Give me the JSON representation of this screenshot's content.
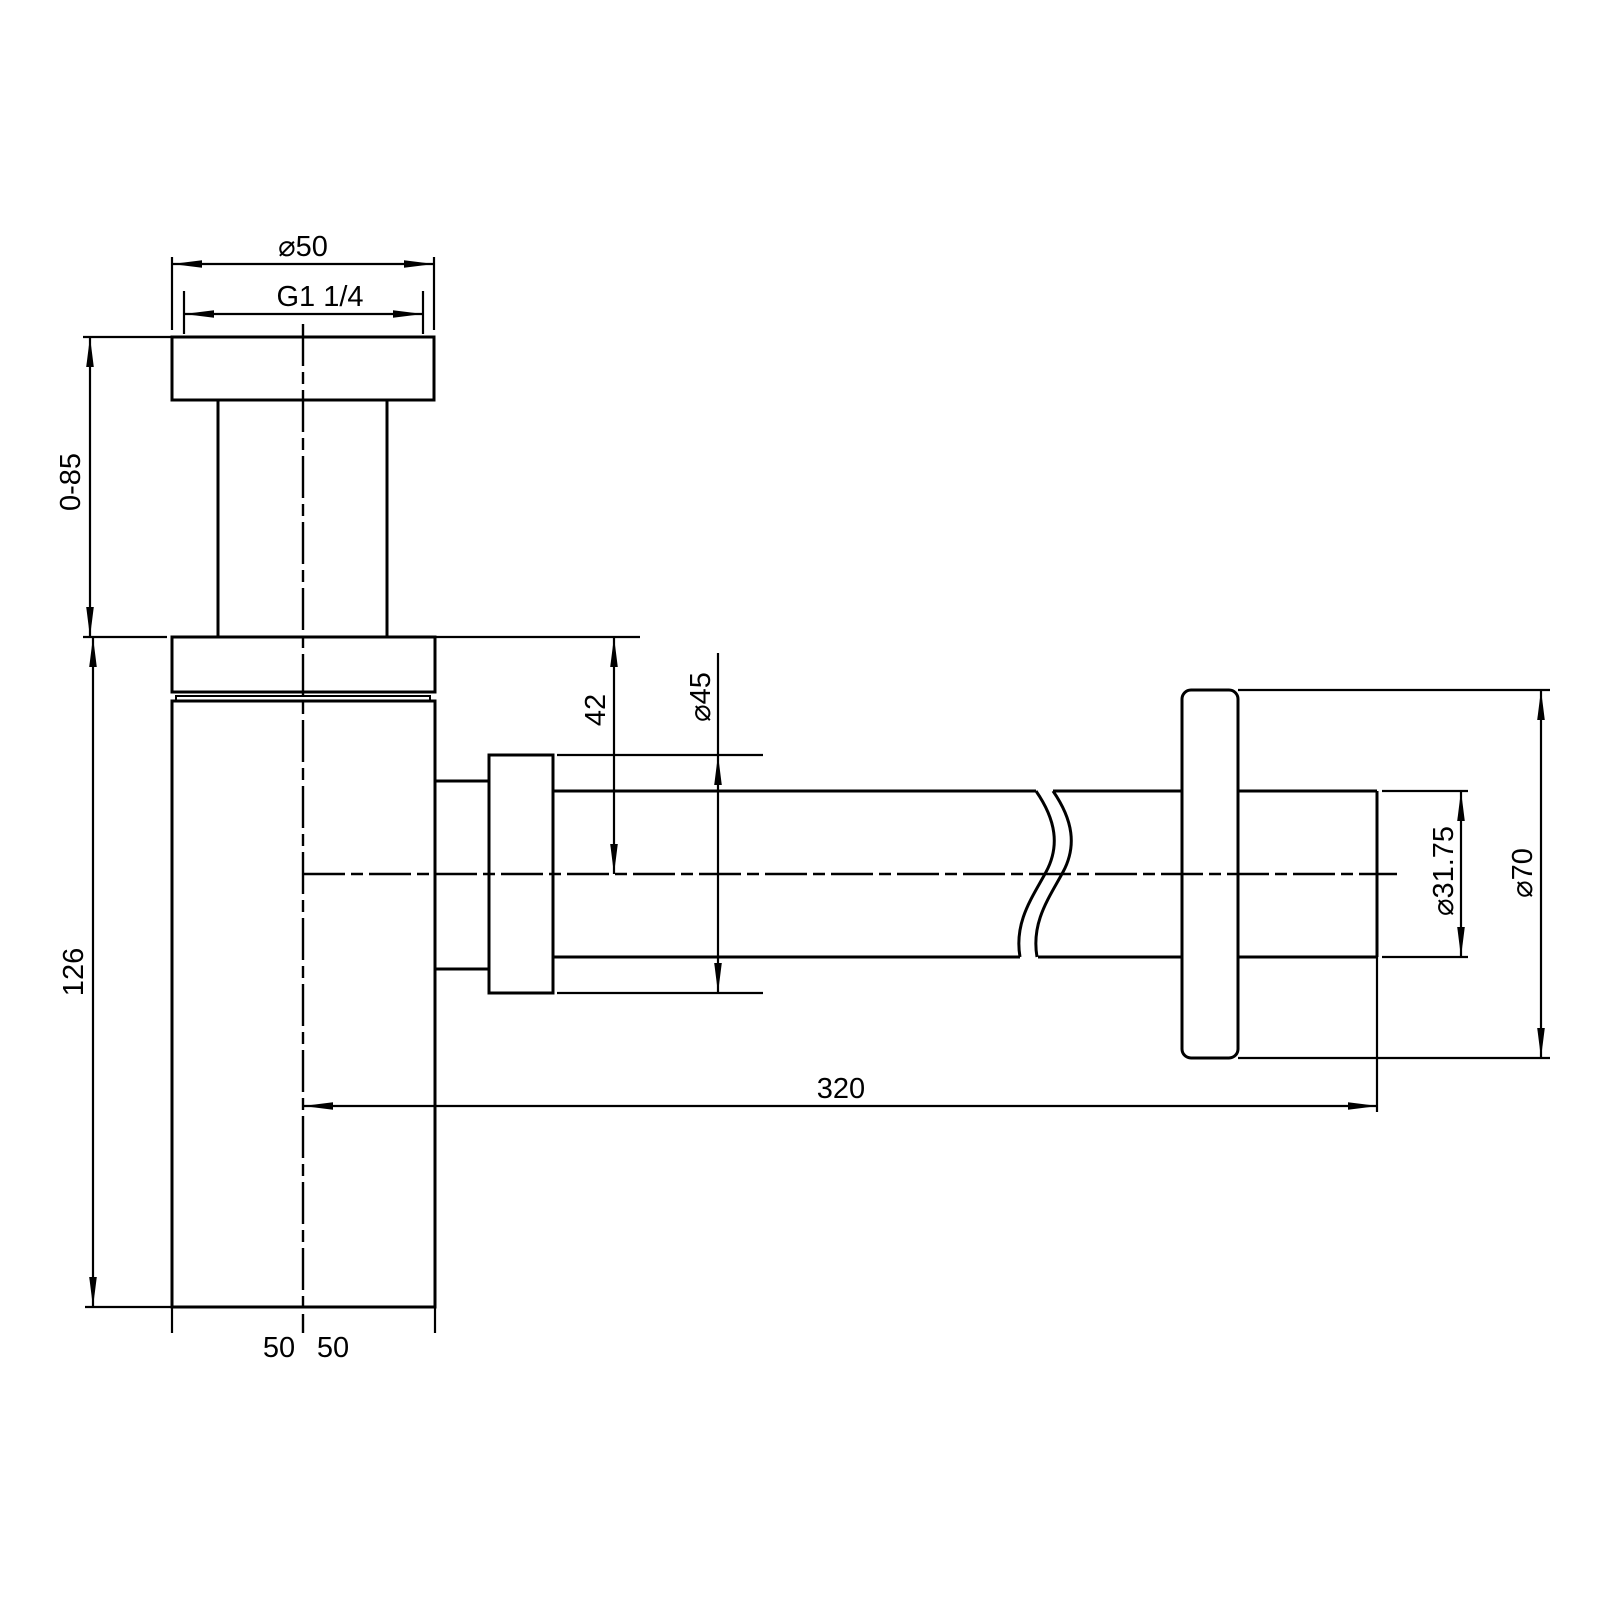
{
  "page": {
    "background": "#ffffff",
    "stroke_color": "#000000",
    "description": "Technical dimension drawing of a basin bottle trap with wall outlet pipe and flange"
  },
  "drawing": {
    "labels": {
      "flange_od": "⌀50",
      "thread_size": "G1 1/4",
      "inlet_adjust_range": "0-85",
      "body_height": "126",
      "outlet_offset": "42",
      "nut_od": "⌀45",
      "bottom_width_left": "50",
      "bottom_width_right": "50",
      "outlet_reach": "320",
      "outlet_pipe_od": "⌀31.75",
      "wall_flange_od": "⌀70"
    }
  }
}
